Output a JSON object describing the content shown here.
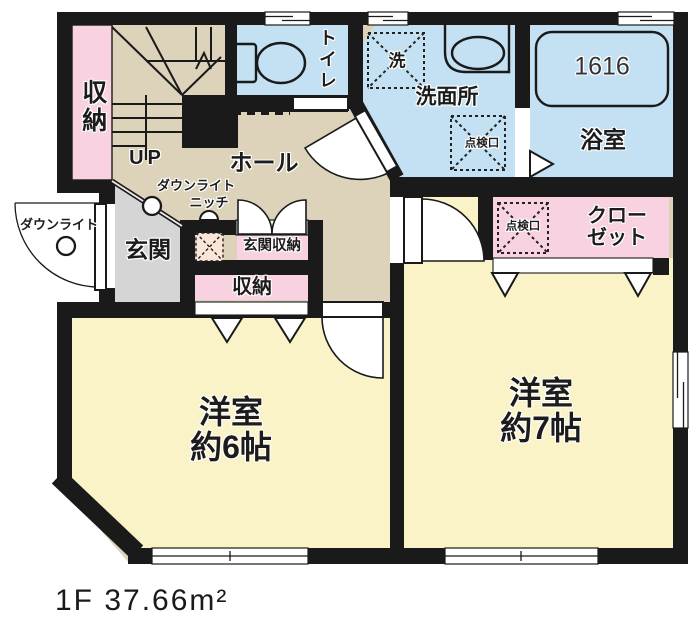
{
  "labels": {
    "storage_top_left": "収納",
    "up": "UP",
    "hall": "ホール",
    "toilet": "トイレ",
    "laundry": "洗",
    "washroom": "洗面所",
    "inspection_hatch_washroom": "点検口",
    "inspection_hatch_closet": "点検口",
    "bathtub_size": "1616",
    "bathroom": "浴室",
    "closet_line1": "クロー",
    "closet_line2": "ゼット",
    "downlight_hall": "ダウンライト",
    "niche": "ニッチ",
    "downlight_porch": "ダウンライト",
    "entrance": "玄関",
    "entrance_storage": "玄関収納",
    "storage_hall": "収納",
    "room6_line1": "洋室",
    "room6_line2": "約6帖",
    "room7_line1": "洋室",
    "room7_line2": "約7帖",
    "floor_caption": "1F 37.66m²"
  },
  "colors": {
    "wall": "#1a1a1a",
    "hall_floor": "#dcd3ba",
    "room_floor": "#faf3c8",
    "wet_floor": "#c3e1f2",
    "storage_pink": "#f8d2e1",
    "entrance_gray": "#d5d5d5",
    "niche_peach": "#fbe5d8",
    "white": "#ffffff"
  }
}
